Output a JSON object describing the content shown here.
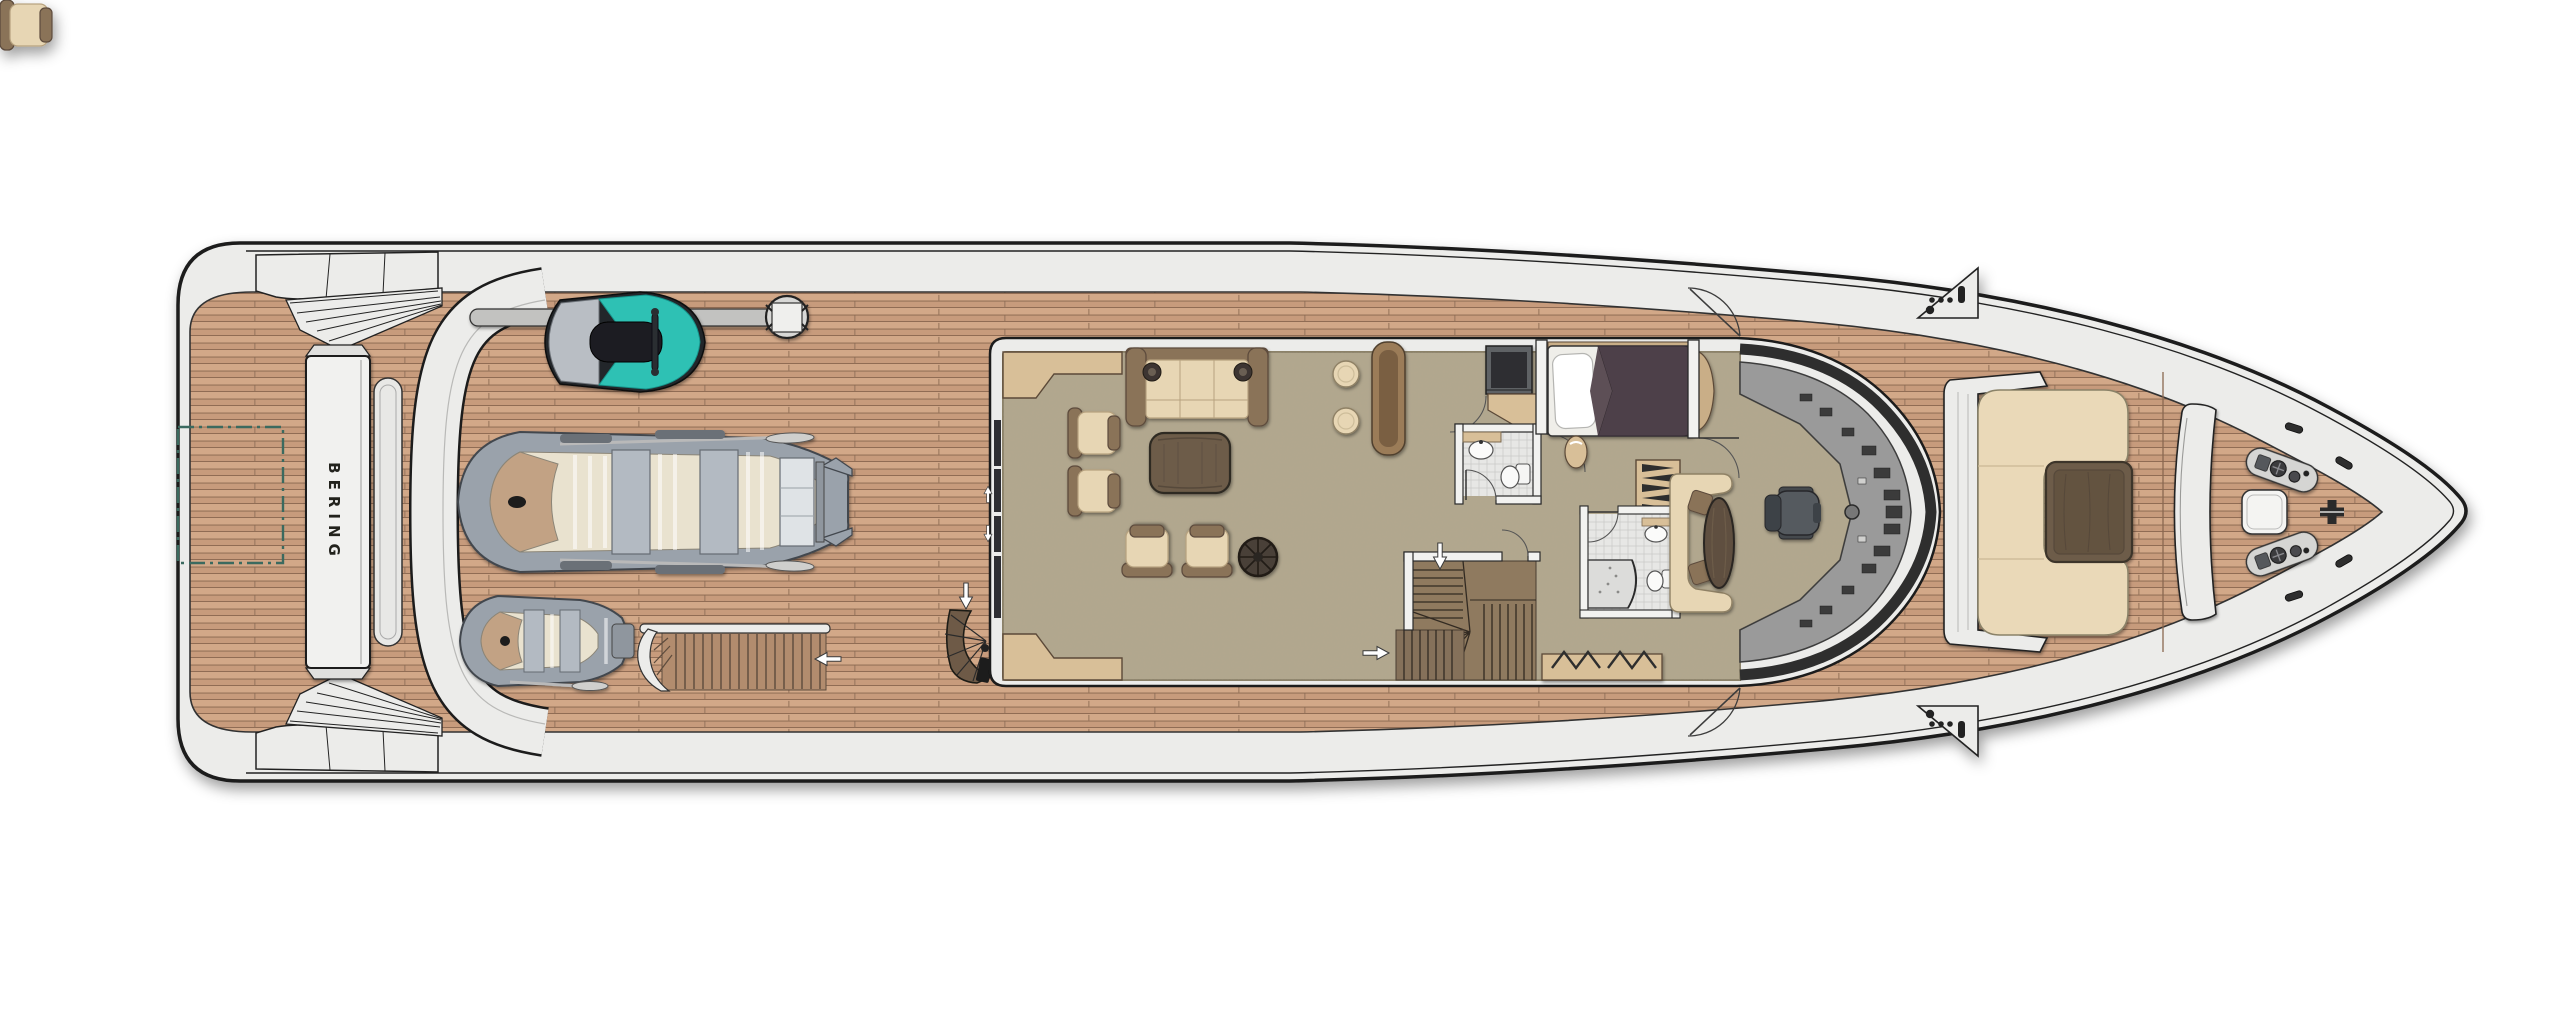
{
  "brand": {
    "name": "BERING"
  },
  "colors": {
    "hull": "#ececea",
    "outline": "#1b1b1b",
    "teak": "#c99d7e",
    "teak_seam": "#8a6750",
    "carpet": "#b2a78d",
    "accent_teal_jetski": "#2fc1b4",
    "marking_dash_teal": "#3a6b5f",
    "cream_upholstery": "#ead9b8",
    "sofa_wood": "#8a7358",
    "light_wood": "#d8bf98",
    "dark_wood_table": "#6d5c49",
    "duvet_purple": "#4e4149",
    "console_gray": "#9a9a9a",
    "windshield_dark": "#2d2d2d",
    "tender_gray": "#9aa2ab",
    "tender_floor": "#e9e2cf",
    "tile": "#e7e7e5",
    "fixture_white": "#fafaf9"
  }
}
